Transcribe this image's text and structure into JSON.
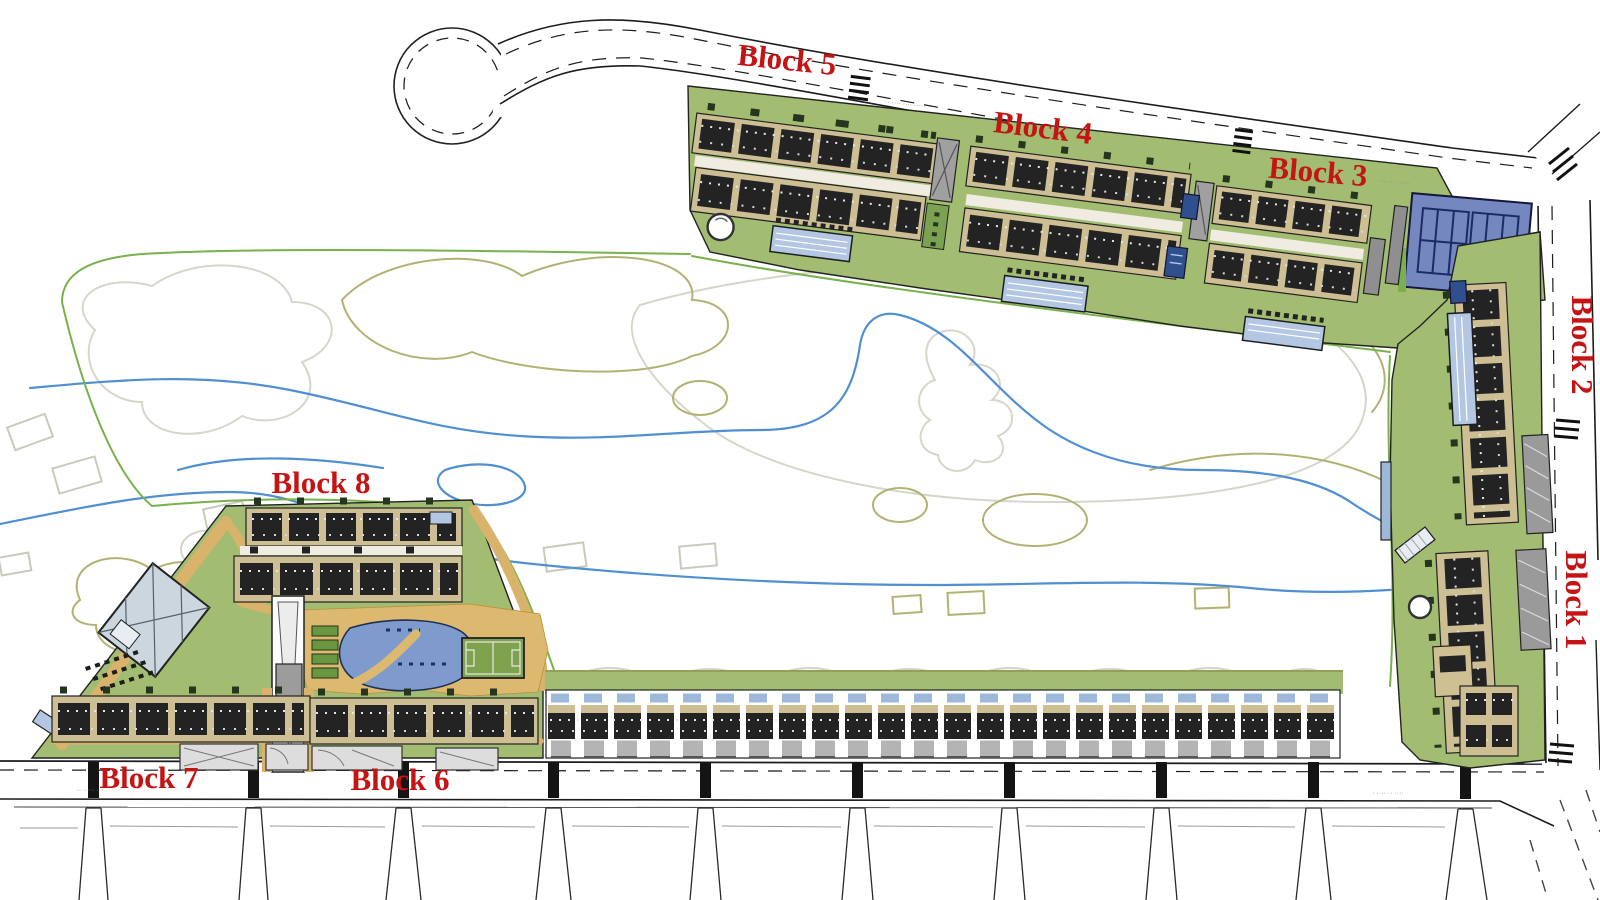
{
  "labels": {
    "blocks": [
      {
        "name": "Block 1"
      },
      {
        "name": "Block 2"
      },
      {
        "name": "Block 3"
      },
      {
        "name": "Block 4"
      },
      {
        "name": "Block 5"
      },
      {
        "name": "Block 6"
      },
      {
        "name": "Block 7"
      },
      {
        "name": "Block 8"
      }
    ]
  },
  "roads": {
    "microtext": [
      {
        "text": "·· ···· ···· ·····"
      },
      {
        "text": "··· ···· ·····"
      },
      {
        "text": "·· ····· ···"
      },
      {
        "text": "· ···· ·· ····"
      }
    ]
  },
  "site": {
    "townhouse_units_visible": 24,
    "tennis_courts_visible": 2
  },
  "palette": {
    "parcel_green": "#a2bd72",
    "path_ochre": "#d9b36c",
    "deck_ochre": "#dcb96f",
    "building_dark": "#232323",
    "band_tan": "#cdbf93",
    "pool_blue": "#7f9bce",
    "lap_pool_blue": "#b3c7e2",
    "tennis_blue": "#7487bf",
    "navy_pool": "#2f4f8e",
    "label_red": "#c41414",
    "contour_gray": "#d3d3c8",
    "contour_olive": "#aeae6c",
    "stream_blue": "#4f8fd2",
    "boundary_green": "#79b24c",
    "ramp_gray": "#9c9c9c"
  }
}
